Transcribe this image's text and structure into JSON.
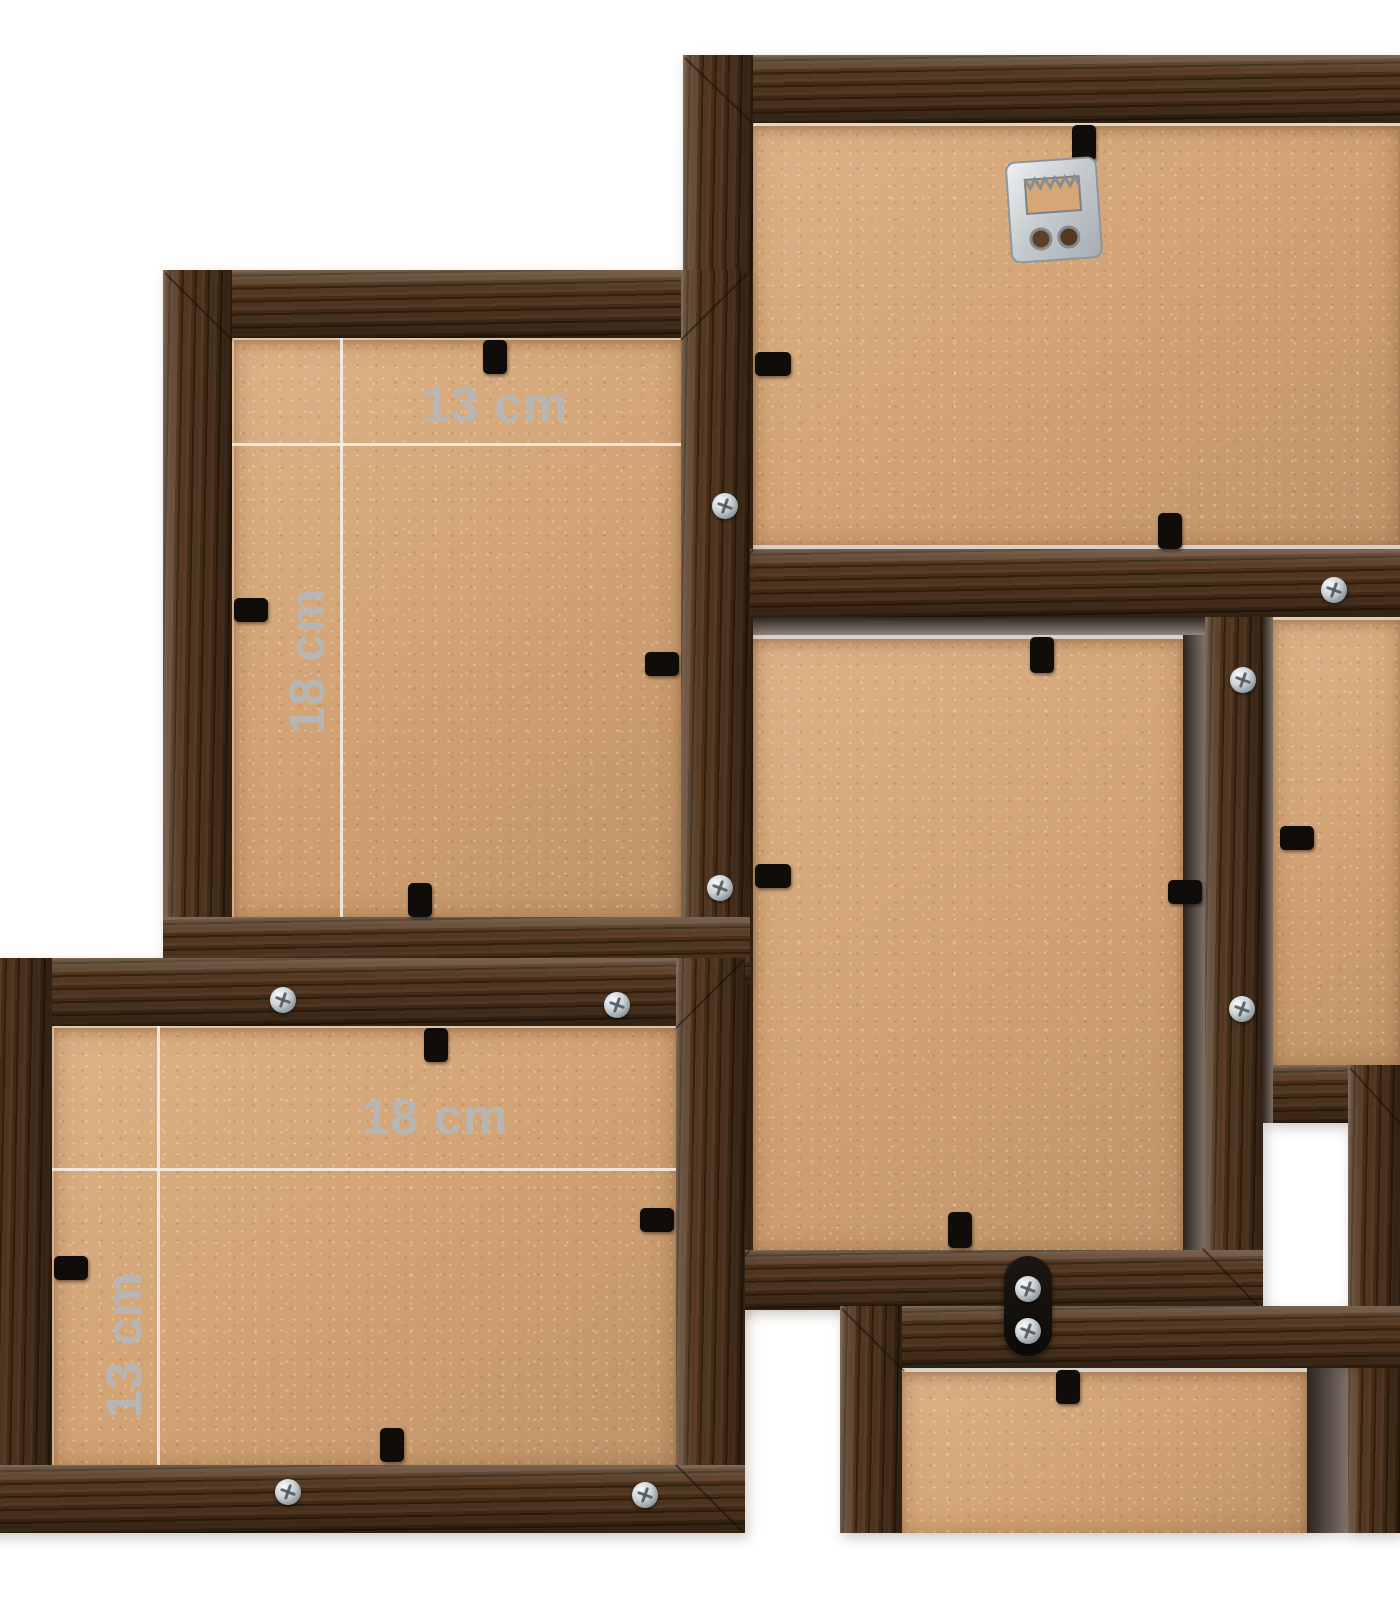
{
  "dimensions": {
    "top_left_frame": {
      "width_label": "13 cm",
      "height_label": "18 cm"
    },
    "bottom_left_frame": {
      "width_label": "18 cm",
      "height_label": "13 cm"
    }
  },
  "colors": {
    "background": "#ffffff",
    "wood_dark": "#35210e",
    "wood_mid": "#49301a",
    "wood_light": "#6e4c34",
    "board": "#d9a877",
    "dimension_label": "#b5b8b9",
    "dimension_line": "#f3f2ee",
    "metal": "#c3c9cc",
    "clip_black": "#0f0c09"
  },
  "hardware": {
    "hanger_icon": "sawtooth-hanger",
    "screw_icon": "phillips-screw",
    "clip_icon": "backing-retainer-clip",
    "bracket_icon": "connector-bracket"
  }
}
